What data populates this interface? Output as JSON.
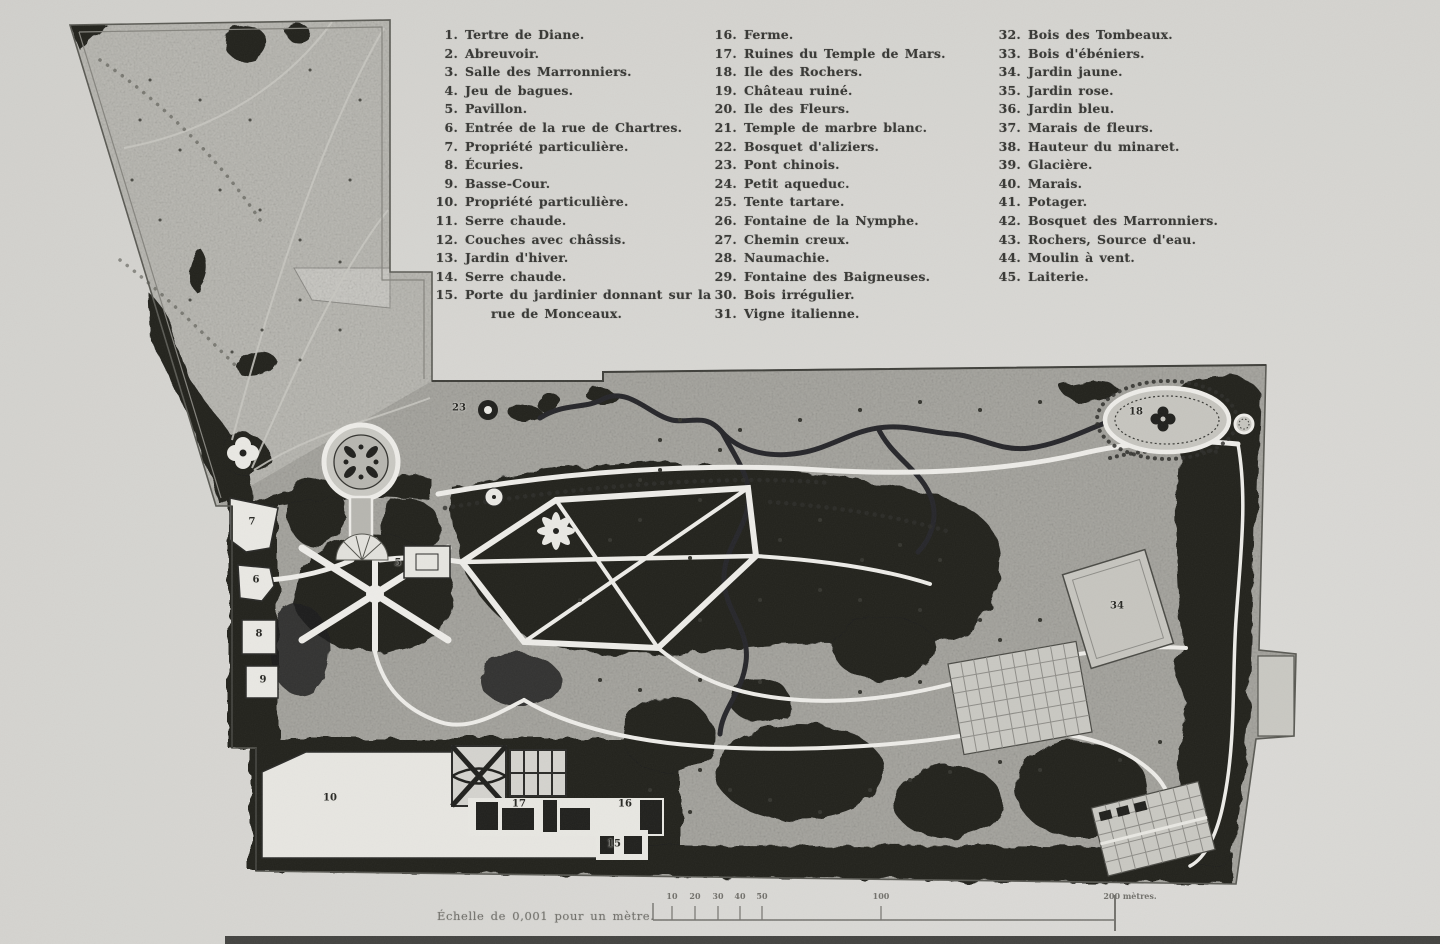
{
  "legend": {
    "columns": [
      {
        "items": [
          {
            "num": "1.",
            "label": "Tertre de Diane."
          },
          {
            "num": "2.",
            "label": "Abreuvoir."
          },
          {
            "num": "3.",
            "label": "Salle des Marronniers."
          },
          {
            "num": "4.",
            "label": "Jeu de bagues."
          },
          {
            "num": "5.",
            "label": "Pavillon."
          },
          {
            "num": "6.",
            "label": "Entrée de la rue de Chartres."
          },
          {
            "num": "7.",
            "label": "Propriété particulière."
          },
          {
            "num": "8.",
            "label": "Écuries."
          },
          {
            "num": "9.",
            "label": "Basse-Cour."
          },
          {
            "num": "10.",
            "label": "Propriété particulière."
          },
          {
            "num": "11.",
            "label": "Serre chaude."
          },
          {
            "num": "12.",
            "label": "Couches avec châssis."
          },
          {
            "num": "13.",
            "label": "Jardin d'hiver."
          },
          {
            "num": "14.",
            "label": "Serre chaude."
          },
          {
            "num": "15.",
            "label": "Porte du jardinier donnant sur la rue de Monceaux."
          }
        ]
      },
      {
        "items": [
          {
            "num": "16.",
            "label": "Ferme."
          },
          {
            "num": "17.",
            "label": "Ruines du Temple de Mars."
          },
          {
            "num": "18.",
            "label": "Ile des Rochers."
          },
          {
            "num": "19.",
            "label": "Château ruiné."
          },
          {
            "num": "20.",
            "label": "Ile des Fleurs."
          },
          {
            "num": "21.",
            "label": "Temple de marbre blanc."
          },
          {
            "num": "22.",
            "label": "Bosquet d'aliziers."
          },
          {
            "num": "23.",
            "label": "Pont chinois."
          },
          {
            "num": "24.",
            "label": "Petit aqueduc."
          },
          {
            "num": "25.",
            "label": "Tente tartare."
          },
          {
            "num": "26.",
            "label": "Fontaine de la Nymphe."
          },
          {
            "num": "27.",
            "label": "Chemin creux."
          },
          {
            "num": "28.",
            "label": "Naumachie."
          },
          {
            "num": "29.",
            "label": "Fontaine des Baigneuses."
          },
          {
            "num": "30.",
            "label": "Bois irrégulier."
          },
          {
            "num": "31.",
            "label": "Vigne italienne."
          }
        ]
      },
      {
        "items": [
          {
            "num": "32.",
            "label": "Bois des Tombeaux."
          },
          {
            "num": "33.",
            "label": "Bois d'ébéniers."
          },
          {
            "num": "34.",
            "label": "Jardin jaune."
          },
          {
            "num": "35.",
            "label": "Jardin rose."
          },
          {
            "num": "36.",
            "label": "Jardin bleu."
          },
          {
            "num": "37.",
            "label": "Marais de fleurs."
          },
          {
            "num": "38.",
            "label": "Hauteur du minaret."
          },
          {
            "num": "39.",
            "label": "Glacière."
          },
          {
            "num": "40.",
            "label": "Marais."
          },
          {
            "num": "41.",
            "label": "Potager."
          },
          {
            "num": "42.",
            "label": "Bosquet des Marronniers."
          },
          {
            "num": "43.",
            "label": "Rochers, Source d'eau."
          },
          {
            "num": "44.",
            "label": "Moulin à vent."
          },
          {
            "num": "45.",
            "label": "Laiterie."
          }
        ]
      }
    ]
  },
  "scale": {
    "caption": "Échelle de 0,001 pour un mètre.",
    "ticks": [
      {
        "label": "10",
        "x": 672
      },
      {
        "label": "20",
        "x": 695
      },
      {
        "label": "30",
        "x": 718
      },
      {
        "label": "40",
        "x": 740
      },
      {
        "label": "50",
        "x": 762
      },
      {
        "label": "100",
        "x": 881
      },
      {
        "label": "200 mètres.",
        "x": 1130
      }
    ]
  },
  "map": {
    "numbers": [
      {
        "n": "23",
        "x": 459,
        "y": 408
      },
      {
        "n": "5",
        "x": 398,
        "y": 563
      },
      {
        "n": "7",
        "x": 252,
        "y": 522
      },
      {
        "n": "6",
        "x": 256,
        "y": 580
      },
      {
        "n": "8",
        "x": 259,
        "y": 634
      },
      {
        "n": "9",
        "x": 263,
        "y": 680
      },
      {
        "n": "10",
        "x": 330,
        "y": 798
      },
      {
        "n": "17",
        "x": 519,
        "y": 804
      },
      {
        "n": "16",
        "x": 625,
        "y": 804
      },
      {
        "n": "15",
        "x": 614,
        "y": 844
      },
      {
        "n": "34",
        "x": 1117,
        "y": 606
      },
      {
        "n": "18",
        "x": 1136,
        "y": 412
      }
    ],
    "colors": {
      "paper": "#d7d6d2",
      "ground": "#a9a8a2",
      "ground_light": "#bcbbb5",
      "woods": "#20201d",
      "path_white": "#edece8"
    }
  }
}
